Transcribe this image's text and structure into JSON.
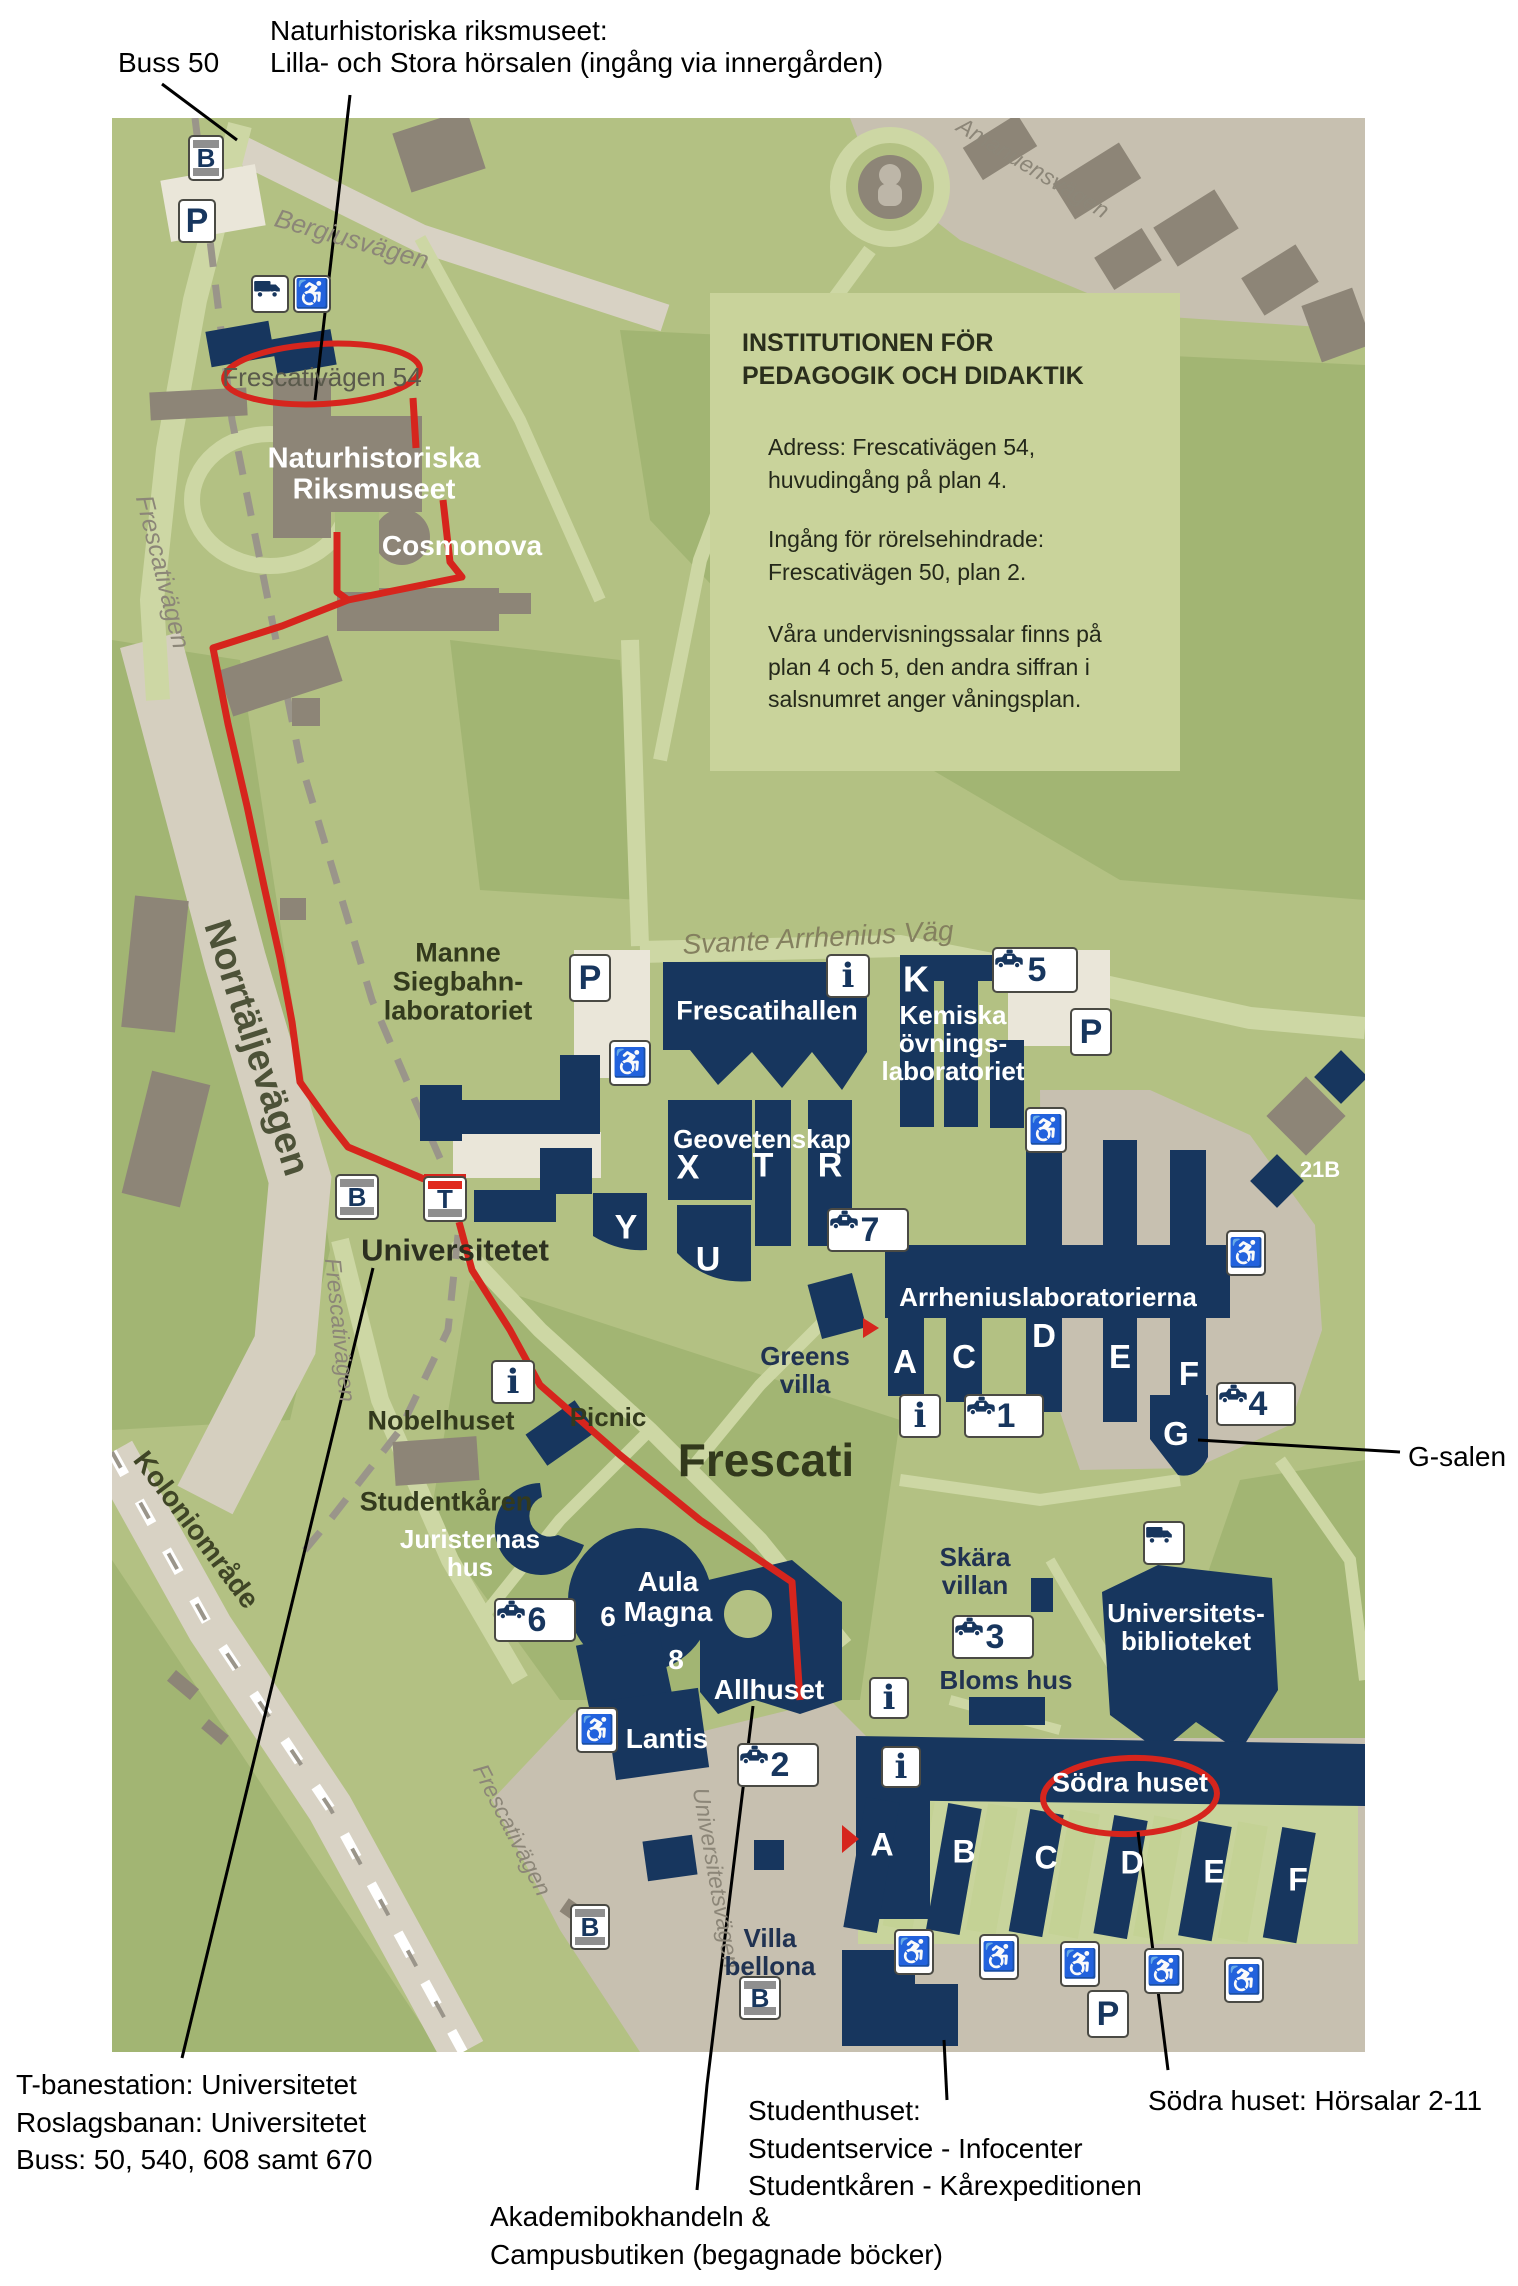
{
  "annotations": {
    "buss50": "Buss 50",
    "nrm_line1": "Naturhistoriska riksmuseet:",
    "nrm_line2": "Lilla- och Stora hörsalen (ingång via innergården)",
    "g_salen": "G-salen",
    "bottom_left": [
      "T-banestation: Universitetet",
      "Roslagsbanan: Universitetet",
      "Buss: 50, 540, 608 samt 670"
    ],
    "bookstore": [
      "Akademibokhandeln &",
      "Campusbutiken (begagnade böcker)"
    ],
    "studenthuset": [
      "Studenthuset:",
      "Studentservice - Infocenter",
      "Studentkåren - Kårexpeditionen"
    ],
    "sodra": "Södra huset: Hörsalar 2-11"
  },
  "infobox": {
    "title": "INSTITUTIONEN FÖR\nPEDAGOGIK OCH DIDAKTIK",
    "para1": "Adress: Frescativägen 54,\nhuvudingång på plan 4.",
    "para2": "Ingång för rörelsehindrade:\nFrescativägen 50, plan 2.",
    "para3": "Våra undervisningssalar finns på\nplan 4 och 5, den andra siffran i\nsalsnumret anger våningsplan."
  },
  "colors": {
    "route_red": "#d6251d",
    "navy": "#17365e",
    "ground": "#b3c183",
    "tan": "#c7c0b0",
    "gray_building": "#8d8577",
    "path": "#cdd7a4"
  },
  "map": {
    "labels": [
      {
        "name": "label-frescativagen-54",
        "text": "Frescativägen 54",
        "x": 322,
        "y": 377,
        "size": 26,
        "color": "#5a5a4c",
        "weight": 400,
        "rot": 0,
        "italic": 0
      },
      {
        "name": "label-naturhistoriska",
        "text": "Naturhistoriska\nRiksmuseet",
        "x": 374,
        "y": 475,
        "size": 29,
        "color": "#ffffff",
        "weight": 700,
        "rot": 0,
        "italic": 0
      },
      {
        "name": "label-cosmonova",
        "text": "Cosmonova",
        "x": 462,
        "y": 546,
        "size": 28,
        "color": "#ffffff",
        "weight": 700,
        "rot": 0,
        "italic": 0
      },
      {
        "name": "label-bergiusvagen",
        "text": "Bergiusvägen",
        "x": 352,
        "y": 239,
        "size": 26,
        "color": "#8c8678",
        "weight": 400,
        "rot": 16,
        "italic": 1
      },
      {
        "name": "label-amanuensvagen",
        "text": "Amanuensvägen",
        "x": 1033,
        "y": 168,
        "size": 23,
        "color": "#8c8678",
        "weight": 400,
        "rot": 31,
        "italic": 1
      },
      {
        "name": "label-frescativagen-upper",
        "text": "Frescativägen",
        "x": 162,
        "y": 572,
        "size": 25,
        "color": "#8c8678",
        "weight": 400,
        "rot": 76,
        "italic": 1
      },
      {
        "name": "label-norrtaljevagen",
        "text": "Norrtäljevägen",
        "x": 256,
        "y": 1048,
        "size": 38,
        "color": "#4d5238",
        "weight": 600,
        "rot": 72,
        "italic": 0
      },
      {
        "name": "label-koloniomrade",
        "text": "Koloniområde",
        "x": 196,
        "y": 1530,
        "size": 28,
        "color": "#3f4526",
        "weight": 600,
        "rot": 53,
        "italic": 0
      },
      {
        "name": "label-frescativagen-mid",
        "text": "Frescativägen",
        "x": 340,
        "y": 1330,
        "size": 23,
        "color": "#8c8678",
        "weight": 400,
        "rot": 84,
        "italic": 1
      },
      {
        "name": "label-frescativagen-lower",
        "text": "Frescativägen",
        "x": 512,
        "y": 1830,
        "size": 23,
        "color": "#8c8678",
        "weight": 400,
        "rot": 63,
        "italic": 1
      },
      {
        "name": "label-universitetsvagen",
        "text": "Universitetsvägen",
        "x": 716,
        "y": 1878,
        "size": 23,
        "color": "#8c8678",
        "weight": 400,
        "rot": 80,
        "italic": 1
      },
      {
        "name": "label-svante-arrhenius-vag",
        "text": "Svante Arrhenius Väg",
        "x": 818,
        "y": 938,
        "size": 28,
        "color": "#84805f",
        "weight": 400,
        "rot": -3,
        "italic": 1
      },
      {
        "name": "label-manne-siegbahn",
        "text": "Manne\nSiegbahn-\nlaboratoriet",
        "x": 458,
        "y": 982,
        "size": 27,
        "color": "#333a1d",
        "weight": 600,
        "rot": 0,
        "italic": 0
      },
      {
        "name": "label-frescatihallen",
        "text": "Frescatihallen",
        "x": 767,
        "y": 1011,
        "size": 27,
        "color": "#ffffff",
        "weight": 700,
        "rot": 0,
        "italic": 0
      },
      {
        "name": "label-k",
        "text": "K",
        "x": 916,
        "y": 980,
        "size": 36,
        "color": "#ffffff",
        "weight": 700,
        "rot": 0,
        "italic": 0
      },
      {
        "name": "label-kemiska",
        "text": "Kemiska\növnings-\nlaboratoriet",
        "x": 953,
        "y": 1043,
        "size": 26,
        "color": "#ffffff",
        "weight": 700,
        "rot": 0,
        "italic": 0
      },
      {
        "name": "label-geovetenskap",
        "text": "Geovetenskap",
        "x": 762,
        "y": 1139,
        "size": 26,
        "color": "#ffffff",
        "weight": 700,
        "rot": 0,
        "italic": 0
      },
      {
        "name": "label-x",
        "text": "X",
        "x": 688,
        "y": 1168,
        "size": 34,
        "color": "#ffffff",
        "weight": 700,
        "rot": 0,
        "italic": 0
      },
      {
        "name": "label-t-geo",
        "text": "T",
        "x": 763,
        "y": 1166,
        "size": 34,
        "color": "#ffffff",
        "weight": 700,
        "rot": 0,
        "italic": 0
      },
      {
        "name": "label-r",
        "text": "R",
        "x": 830,
        "y": 1166,
        "size": 34,
        "color": "#ffffff",
        "weight": 700,
        "rot": 0,
        "italic": 0
      },
      {
        "name": "label-y",
        "text": "Y",
        "x": 626,
        "y": 1228,
        "size": 34,
        "color": "#ffffff",
        "weight": 700,
        "rot": 0,
        "italic": 0
      },
      {
        "name": "label-u",
        "text": "U",
        "x": 708,
        "y": 1260,
        "size": 34,
        "color": "#ffffff",
        "weight": 700,
        "rot": 0,
        "italic": 0
      },
      {
        "name": "label-21b",
        "text": "21B",
        "x": 1320,
        "y": 1170,
        "size": 22,
        "color": "#ffffff",
        "weight": 700,
        "rot": 0,
        "italic": 0
      },
      {
        "name": "label-arrheniuslaboratorierna",
        "text": "Arrheniuslaboratorierna",
        "x": 1048,
        "y": 1297,
        "size": 26,
        "color": "#ffffff",
        "weight": 700,
        "rot": 0,
        "italic": 0
      },
      {
        "name": "label-arrhenius-a",
        "text": "A",
        "x": 905,
        "y": 1362,
        "size": 33,
        "color": "#ffffff",
        "weight": 700,
        "rot": 0,
        "italic": 0
      },
      {
        "name": "label-arrhenius-c",
        "text": "C",
        "x": 964,
        "y": 1357,
        "size": 33,
        "color": "#ffffff",
        "weight": 700,
        "rot": 0,
        "italic": 0
      },
      {
        "name": "label-arrhenius-d",
        "text": "D",
        "x": 1044,
        "y": 1336,
        "size": 33,
        "color": "#ffffff",
        "weight": 700,
        "rot": 0,
        "italic": 0
      },
      {
        "name": "label-arrhenius-e",
        "text": "E",
        "x": 1120,
        "y": 1357,
        "size": 33,
        "color": "#ffffff",
        "weight": 700,
        "rot": 0,
        "italic": 0
      },
      {
        "name": "label-arrhenius-f",
        "text": "F",
        "x": 1189,
        "y": 1374,
        "size": 33,
        "color": "#ffffff",
        "weight": 700,
        "rot": 0,
        "italic": 0
      },
      {
        "name": "label-arrhenius-g",
        "text": "G",
        "x": 1176,
        "y": 1434,
        "size": 33,
        "color": "#ffffff",
        "weight": 700,
        "rot": 0,
        "italic": 0
      },
      {
        "name": "label-universitetet",
        "text": "Universitetet",
        "x": 455,
        "y": 1250,
        "size": 31,
        "color": "#2c3020",
        "weight": 700,
        "rot": 0,
        "italic": 0
      },
      {
        "name": "label-nobelhuset",
        "text": "Nobelhuset",
        "x": 441,
        "y": 1421,
        "size": 27,
        "color": "#333a1d",
        "weight": 600,
        "rot": 0,
        "italic": 0
      },
      {
        "name": "label-picnic",
        "text": "Picnic",
        "x": 608,
        "y": 1417,
        "size": 26,
        "color": "#333a1d",
        "weight": 600,
        "rot": 0,
        "italic": 0
      },
      {
        "name": "label-greens-villa",
        "text": "Greens\nvilla",
        "x": 805,
        "y": 1370,
        "size": 26,
        "color": "#203251",
        "weight": 600,
        "rot": 0,
        "italic": 0
      },
      {
        "name": "label-frescati",
        "text": "Frescati",
        "x": 766,
        "y": 1461,
        "size": 46,
        "color": "#32391c",
        "weight": 600,
        "rot": 0,
        "italic": 0
      },
      {
        "name": "label-studentkaren",
        "text": "Studentkåren",
        "x": 446,
        "y": 1502,
        "size": 27,
        "color": "#333a1d",
        "weight": 600,
        "rot": 0,
        "italic": 0
      },
      {
        "name": "label-juristernas-hus",
        "text": "Juristernas\nhus",
        "x": 470,
        "y": 1553,
        "size": 26,
        "color": "#ffffff",
        "weight": 700,
        "rot": 0,
        "italic": 0
      },
      {
        "name": "label-aula-magna",
        "text": "Aula\nMagna",
        "x": 668,
        "y": 1597,
        "size": 28,
        "color": "#ffffff",
        "weight": 700,
        "rot": 0,
        "italic": 0
      },
      {
        "name": "label-6",
        "text": "6",
        "x": 608,
        "y": 1617,
        "size": 28,
        "color": "#ffffff",
        "weight": 700,
        "rot": 0,
        "italic": 0
      },
      {
        "name": "label-8",
        "text": "8",
        "x": 676,
        "y": 1660,
        "size": 28,
        "color": "#ffffff",
        "weight": 700,
        "rot": 0,
        "italic": 0
      },
      {
        "name": "label-allhuset",
        "text": "Allhuset",
        "x": 769,
        "y": 1690,
        "size": 28,
        "color": "#ffffff",
        "weight": 700,
        "rot": 0,
        "italic": 0
      },
      {
        "name": "label-lantis",
        "text": "Lantis",
        "x": 667,
        "y": 1739,
        "size": 28,
        "color": "#ffffff",
        "weight": 700,
        "rot": 0,
        "italic": 0
      },
      {
        "name": "label-skara-villan",
        "text": "Skära\nvillan",
        "x": 975,
        "y": 1571,
        "size": 26,
        "color": "#203251",
        "weight": 600,
        "rot": 0,
        "italic": 0
      },
      {
        "name": "label-bloms-hus",
        "text": "Bloms hus",
        "x": 1006,
        "y": 1680,
        "size": 26,
        "color": "#203251",
        "weight": 600,
        "rot": 0,
        "italic": 0
      },
      {
        "name": "label-universitetsbiblioteket",
        "text": "Universitets-\nbiblioteket",
        "x": 1186,
        "y": 1627,
        "size": 26,
        "color": "#ffffff",
        "weight": 700,
        "rot": 0,
        "italic": 0
      },
      {
        "name": "label-sodra-huset",
        "text": "Södra huset",
        "x": 1130,
        "y": 1783,
        "size": 27,
        "color": "#ffffff",
        "weight": 700,
        "rot": 0,
        "italic": 0
      },
      {
        "name": "label-sodra-a",
        "text": "A",
        "x": 882,
        "y": 1845,
        "size": 32,
        "color": "#ffffff",
        "weight": 700,
        "rot": 0,
        "italic": 0
      },
      {
        "name": "label-sodra-b",
        "text": "B",
        "x": 964,
        "y": 1852,
        "size": 32,
        "color": "#ffffff",
        "weight": 700,
        "rot": 0,
        "italic": 0
      },
      {
        "name": "label-sodra-c",
        "text": "C",
        "x": 1046,
        "y": 1858,
        "size": 32,
        "color": "#ffffff",
        "weight": 700,
        "rot": 0,
        "italic": 0
      },
      {
        "name": "label-sodra-d",
        "text": "D",
        "x": 1132,
        "y": 1863,
        "size": 32,
        "color": "#ffffff",
        "weight": 700,
        "rot": 0,
        "italic": 0
      },
      {
        "name": "label-sodra-e",
        "text": "E",
        "x": 1214,
        "y": 1872,
        "size": 32,
        "color": "#ffffff",
        "weight": 700,
        "rot": 0,
        "italic": 0
      },
      {
        "name": "label-sodra-f",
        "text": "F",
        "x": 1298,
        "y": 1880,
        "size": 32,
        "color": "#ffffff",
        "weight": 700,
        "rot": 0,
        "italic": 0
      },
      {
        "name": "label-villa-bellona",
        "text": "Villa\nbellona",
        "x": 770,
        "y": 1952,
        "size": 26,
        "color": "#203251",
        "weight": 600,
        "rot": 0,
        "italic": 0
      }
    ],
    "icons": [
      {
        "name": "bus-stop-icon",
        "kind": "busstop",
        "label": "B",
        "x": 206,
        "y": 158,
        "w": 36,
        "h": 46
      },
      {
        "name": "parking-icon",
        "kind": "parking",
        "label": "P",
        "x": 197,
        "y": 221,
        "w": 38,
        "h": 44
      },
      {
        "name": "truck-icon",
        "kind": "truck",
        "label": "",
        "x": 270,
        "y": 294,
        "w": 38,
        "h": 38
      },
      {
        "name": "wheelchair-icon",
        "kind": "wheelchair",
        "label": "♿",
        "x": 312,
        "y": 294,
        "w": 38,
        "h": 38
      },
      {
        "name": "parking-icon",
        "kind": "parking",
        "label": "P",
        "x": 590,
        "y": 978,
        "w": 42,
        "h": 48
      },
      {
        "name": "info-icon",
        "kind": "info",
        "label": "i",
        "x": 848,
        "y": 976,
        "w": 44,
        "h": 44
      },
      {
        "name": "taxi-icon",
        "kind": "taxi",
        "label": "5",
        "x": 1035,
        "y": 970,
        "w": 86,
        "h": 46
      },
      {
        "name": "parking-icon",
        "kind": "parking",
        "label": "P",
        "x": 1091,
        "y": 1032,
        "w": 42,
        "h": 48
      },
      {
        "name": "wheelchair-icon",
        "kind": "wheelchair",
        "label": "♿",
        "x": 630,
        "y": 1063,
        "w": 42,
        "h": 46
      },
      {
        "name": "wheelchair-icon",
        "kind": "wheelchair",
        "label": "♿",
        "x": 1046,
        "y": 1130,
        "w": 42,
        "h": 46
      },
      {
        "name": "bus-stop-icon",
        "kind": "busstop",
        "label": "B",
        "x": 357,
        "y": 1197,
        "w": 44,
        "h": 46
      },
      {
        "name": "tbana-icon",
        "kind": "tbana",
        "label": "T",
        "x": 445,
        "y": 1199,
        "w": 44,
        "h": 46
      },
      {
        "name": "wheelchair-icon",
        "kind": "wheelchair",
        "label": "♿",
        "x": 1246,
        "y": 1253,
        "w": 40,
        "h": 46
      },
      {
        "name": "taxi-icon",
        "kind": "taxi",
        "label": "7",
        "x": 868,
        "y": 1230,
        "w": 82,
        "h": 44
      },
      {
        "name": "info-icon",
        "kind": "info",
        "label": "i",
        "x": 513,
        "y": 1382,
        "w": 44,
        "h": 44
      },
      {
        "name": "info-icon",
        "kind": "info",
        "label": "i",
        "x": 920,
        "y": 1416,
        "w": 42,
        "h": 44
      },
      {
        "name": "taxi-icon",
        "kind": "taxi",
        "label": "1",
        "x": 1004,
        "y": 1416,
        "w": 80,
        "h": 44
      },
      {
        "name": "taxi-icon",
        "kind": "taxi",
        "label": "4",
        "x": 1256,
        "y": 1404,
        "w": 80,
        "h": 44
      },
      {
        "name": "taxi-icon",
        "kind": "taxi",
        "label": "6",
        "x": 535,
        "y": 1620,
        "w": 82,
        "h": 44
      },
      {
        "name": "wheelchair-icon",
        "kind": "wheelchair",
        "label": "♿",
        "x": 597,
        "y": 1730,
        "w": 42,
        "h": 46
      },
      {
        "name": "taxi-icon",
        "kind": "taxi",
        "label": "2",
        "x": 778,
        "y": 1765,
        "w": 82,
        "h": 44
      },
      {
        "name": "info-icon",
        "kind": "info",
        "label": "i",
        "x": 889,
        "y": 1698,
        "w": 40,
        "h": 42
      },
      {
        "name": "info-icon",
        "kind": "info",
        "label": "i",
        "x": 901,
        "y": 1767,
        "w": 40,
        "h": 42
      },
      {
        "name": "taxi-icon",
        "kind": "taxi",
        "label": "3",
        "x": 993,
        "y": 1637,
        "w": 82,
        "h": 44
      },
      {
        "name": "truck-icon",
        "kind": "truck",
        "label": "",
        "x": 1164,
        "y": 1543,
        "w": 42,
        "h": 44
      },
      {
        "name": "bus-stop-icon",
        "kind": "busstop",
        "label": "B",
        "x": 590,
        "y": 1927,
        "w": 40,
        "h": 46
      },
      {
        "name": "bus-stop-icon",
        "kind": "busstop",
        "label": "B",
        "x": 760,
        "y": 1998,
        "w": 42,
        "h": 44
      },
      {
        "name": "wheelchair-icon",
        "kind": "wheelchair",
        "label": "♿",
        "x": 914,
        "y": 1952,
        "w": 40,
        "h": 46
      },
      {
        "name": "wheelchair-icon",
        "kind": "wheelchair",
        "label": "♿",
        "x": 999,
        "y": 1957,
        "w": 40,
        "h": 46
      },
      {
        "name": "wheelchair-icon",
        "kind": "wheelchair",
        "label": "♿",
        "x": 1080,
        "y": 1964,
        "w": 40,
        "h": 46
      },
      {
        "name": "wheelchair-icon",
        "kind": "wheelchair",
        "label": "♿",
        "x": 1164,
        "y": 1971,
        "w": 40,
        "h": 46
      },
      {
        "name": "wheelchair-icon",
        "kind": "wheelchair",
        "label": "♿",
        "x": 1244,
        "y": 1980,
        "w": 40,
        "h": 46
      },
      {
        "name": "parking-icon",
        "kind": "parking",
        "label": "P",
        "x": 1108,
        "y": 2014,
        "w": 42,
        "h": 48
      }
    ]
  }
}
